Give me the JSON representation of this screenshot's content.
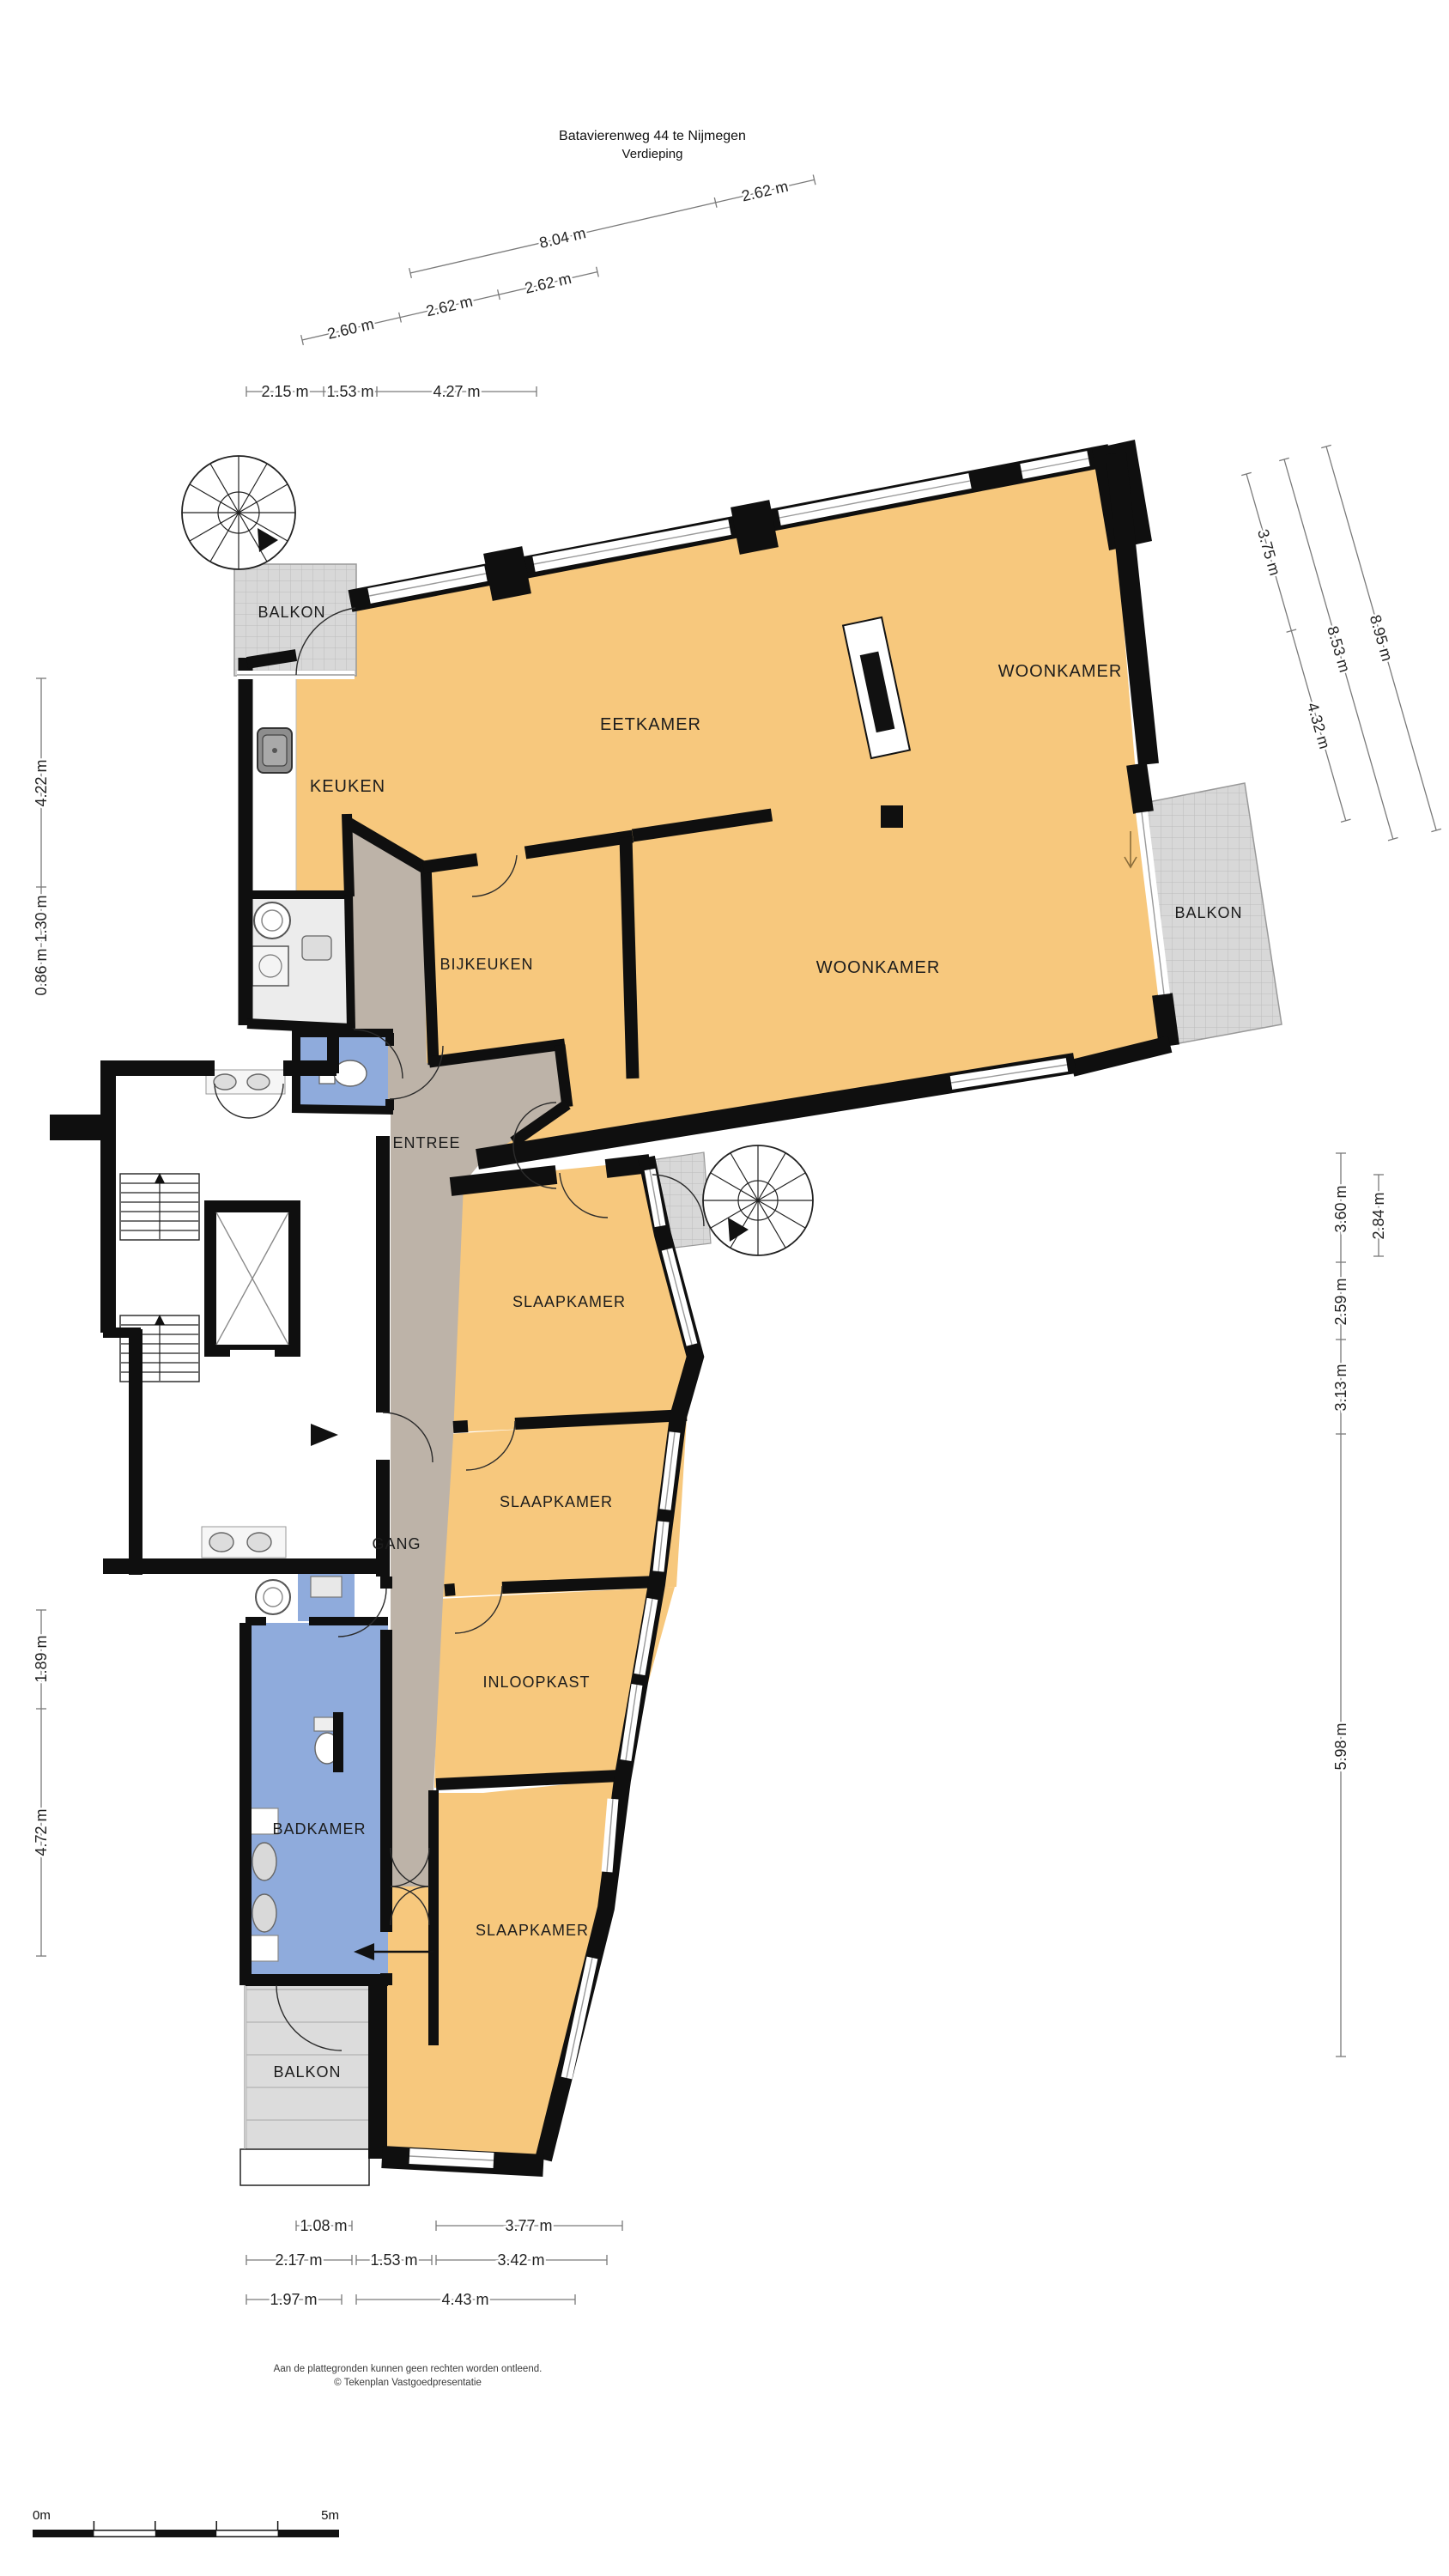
{
  "title": {
    "line1": "Batavierenweg 44 te Nijmegen",
    "line2": "Verdieping"
  },
  "plan": {
    "rooms": [
      {
        "id": "balkon-linksboven",
        "label": "BALKON"
      },
      {
        "id": "keuken",
        "label": "KEUKEN"
      },
      {
        "id": "eetkamer",
        "label": "EETKAMER"
      },
      {
        "id": "woonkamer-boven",
        "label": "WOONKAMER"
      },
      {
        "id": "bijkeuken",
        "label": "BIJKEUKEN"
      },
      {
        "id": "woonkamer",
        "label": "WOONKAMER"
      },
      {
        "id": "balkon-rechts",
        "label": "BALKON"
      },
      {
        "id": "entree",
        "label": "ENTREE"
      },
      {
        "id": "slaapkamer-1",
        "label": "SLAAPKAMER"
      },
      {
        "id": "slaapkamer-2",
        "label": "SLAAPKAMER"
      },
      {
        "id": "gang",
        "label": "GANG"
      },
      {
        "id": "inloopkast",
        "label": "INLOOPKAST"
      },
      {
        "id": "badkamer",
        "label": "BADKAMER"
      },
      {
        "id": "slaapkamer-3",
        "label": "SLAAPKAMER"
      },
      {
        "id": "balkon-linksonder",
        "label": "BALKON"
      }
    ]
  },
  "dimensions": {
    "top_diagonal": [
      "8.04 m",
      "2.62 m",
      "2.60 m",
      "2.62 m",
      "2.62 m"
    ],
    "top_horizontal": [
      "2.15 m",
      "1.53 m",
      "4.27 m"
    ],
    "left_upper": [
      "4.22 m",
      "1.30 m",
      "0.86 m"
    ],
    "left_lower": [
      "1.89 m",
      "4.72 m"
    ],
    "right_diagonal": [
      "3.75 m",
      "4.32 m",
      "8.53 m",
      "8.95 m"
    ],
    "right_vertical": [
      "3.60 m",
      "2.84 m",
      "2.59 m",
      "3.13 m",
      "5.98 m"
    ],
    "bottom_row1": [
      "1.08 m",
      "3.77 m"
    ],
    "bottom_row2": [
      "2.17 m",
      "1.53 m",
      "3.42 m"
    ],
    "bottom_row3": [
      "1.97 m",
      "4.43 m"
    ]
  },
  "scale_bar": {
    "start": "0m",
    "end": "5m"
  },
  "footer": {
    "line1": "Aan de plattegronden kunnen geen rechten worden ontleend.",
    "line2": "© Tekenplan Vastgoedpresentatie"
  },
  "colors": {
    "floor": "#F7C87D",
    "corridor": "#BDB3A8",
    "wet": "#8FABDC",
    "balcony": "#D8D8D8",
    "wall": "#0f0f0f",
    "dim": "#7a7a7a",
    "ink": "#1c1c1c"
  }
}
